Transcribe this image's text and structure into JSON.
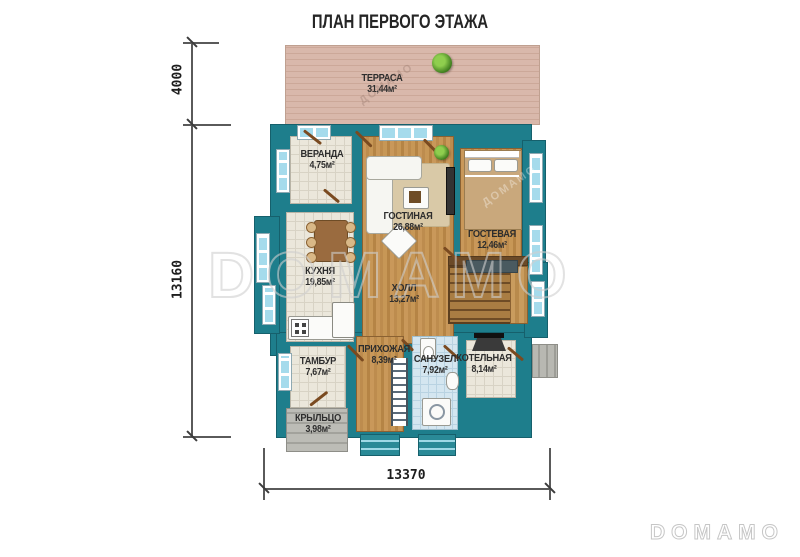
{
  "title": "ПЛАН ПЕРВОГО ЭТАЖА",
  "watermarks": {
    "center": "DOMAMO",
    "corner": "DOMAMO",
    "diag_terrace": "ДОМАМО",
    "diag_guest": "ДОМАМО"
  },
  "dimensions": {
    "terrace_height": "4000",
    "building_height": "13160",
    "building_width": "13370"
  },
  "rooms": {
    "terrace": {
      "name": "ТЕРРАСА",
      "area": "31,44м²"
    },
    "veranda": {
      "name": "ВЕРАНДА",
      "area": "4,75м²"
    },
    "living": {
      "name": "ГОСТИНАЯ",
      "area": "26,88м²"
    },
    "guest": {
      "name": "ГОСТЕВАЯ",
      "area": "12,46м²"
    },
    "kitchen": {
      "name": "КУХНЯ",
      "area": "19,85м²"
    },
    "hall": {
      "name": "ХОЛЛ",
      "area": "13,27м²"
    },
    "tambour": {
      "name": "ТАМБУР",
      "area": "7,67м²"
    },
    "hallway": {
      "name": "ПРИХОЖАЯ",
      "area": "8,39м²"
    },
    "bathroom": {
      "name": "САНУЗЕЛ",
      "area": "7,92м²"
    },
    "boiler": {
      "name": "КОТЕЛЬНАЯ",
      "area": "8,14м²"
    },
    "porch": {
      "name": "КРЫЛЬЦО",
      "area": "3,98м²"
    }
  },
  "colors": {
    "wall": "#1e7e8c",
    "wood_floor": "#c9985a",
    "tile_floor": "#ebe7db",
    "bath_tile": "#d4e6f0",
    "terrace_deck": "#d9b8ab",
    "window_glass": "#a5dbec",
    "door": "#7a4a20",
    "watermark": "#cfcfcf"
  }
}
